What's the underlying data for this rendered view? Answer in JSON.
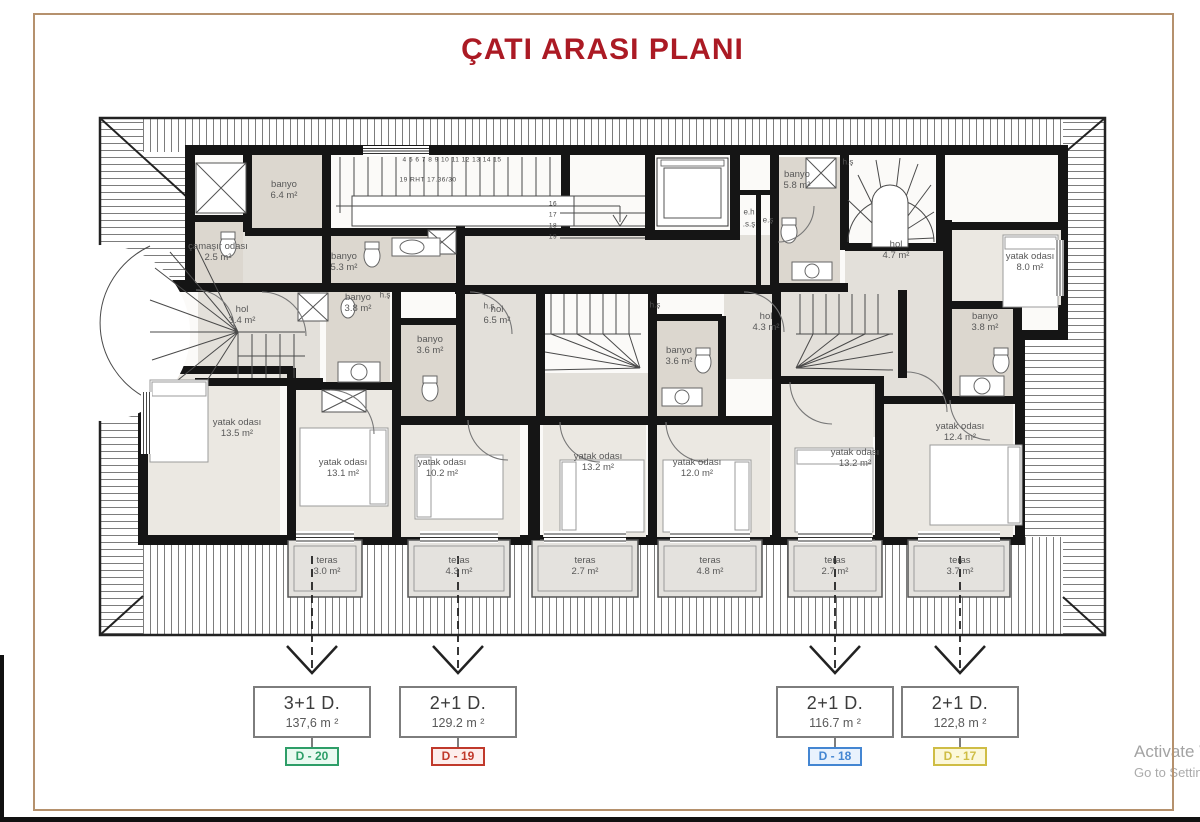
{
  "title": "ÇATI ARASI PLANI",
  "watermark": {
    "line1": "Activate W",
    "line2": "Go to Settin"
  },
  "plan": {
    "rooms": [
      {
        "name": "banyo",
        "area": "6.4 m²",
        "x": 284,
        "y": 190
      },
      {
        "name": "çamaşır odası",
        "area": "2.5 m²",
        "x": 218,
        "y": 252,
        "w": 60,
        "wrap": true
      },
      {
        "name": "banyo",
        "area": "5.3 m²",
        "x": 344,
        "y": 262
      },
      {
        "name": "hol",
        "area": "3.4 m²",
        "x": 242,
        "y": 315
      },
      {
        "name": "banyo",
        "area": "3.8 m²",
        "x": 358,
        "y": 303
      },
      {
        "name": "banyo",
        "area": "3.6 m²",
        "x": 430,
        "y": 345
      },
      {
        "name": "hol",
        "area": "6.5 m²",
        "x": 497,
        "y": 315
      },
      {
        "name": "yatak odası",
        "area": "13.5 m²",
        "x": 237,
        "y": 428
      },
      {
        "name": "yatak odası",
        "area": "13.1 m²",
        "x": 343,
        "y": 468
      },
      {
        "name": "yatak odası",
        "area": "10.2 m²",
        "x": 442,
        "y": 468
      },
      {
        "name": "yatak odası",
        "area": "13.2 m²",
        "x": 598,
        "y": 462
      },
      {
        "name": "yatak odası",
        "area": "12.0 m²",
        "x": 697,
        "y": 468
      },
      {
        "name": "banyo",
        "area": "3.6 m²",
        "x": 679,
        "y": 356
      },
      {
        "name": "hol",
        "area": "4.3 m²",
        "x": 766,
        "y": 322
      },
      {
        "name": "banyo",
        "area": "5.8 m²",
        "x": 797,
        "y": 180
      },
      {
        "name": "hol",
        "area": "4.7 m²",
        "x": 896,
        "y": 250
      },
      {
        "name": "yatak odası",
        "area": "8.0 m²",
        "x": 1030,
        "y": 262
      },
      {
        "name": "banyo",
        "area": "3.8 m²",
        "x": 985,
        "y": 322
      },
      {
        "name": "yatak odası",
        "area": "13.2 m²",
        "x": 855,
        "y": 458
      },
      {
        "name": "yatak odası",
        "area": "12.4 m²",
        "x": 960,
        "y": 432
      },
      {
        "name": "teras",
        "area": "3.0 m²",
        "x": 327,
        "y": 566
      },
      {
        "name": "teras",
        "area": "4.3 m²",
        "x": 459,
        "y": 566
      },
      {
        "name": "teras",
        "area": "2.7 m²",
        "x": 585,
        "y": 566
      },
      {
        "name": "teras",
        "area": "4.8 m²",
        "x": 710,
        "y": 566
      },
      {
        "name": "teras",
        "area": "2.7 m²",
        "x": 835,
        "y": 566
      },
      {
        "name": "teras",
        "area": "3.7 m²",
        "x": 960,
        "y": 566
      }
    ],
    "small_labels": [
      {
        "text": "h.ş",
        "x": 385,
        "y": 295
      },
      {
        "text": "h.ş",
        "x": 489,
        "y": 306
      },
      {
        "text": "h.ş",
        "x": 655,
        "y": 305
      },
      {
        "text": "h.ş",
        "x": 848,
        "y": 162
      },
      {
        "text": "e.h",
        "x": 749,
        "y": 212
      },
      {
        "text": ".s.ş",
        "x": 749,
        "y": 224
      },
      {
        "text": "e.ş",
        "x": 768,
        "y": 220
      }
    ],
    "stair_notes": [
      {
        "text": "19 RHT 17.36/30",
        "x": 428,
        "y": 180
      },
      {
        "text": "4    5    6    7    8    9    10    11    12    13    14    15",
        "x": 452,
        "y": 160
      },
      {
        "text": "16",
        "x": 553,
        "y": 204
      },
      {
        "text": "17",
        "x": 553,
        "y": 215
      },
      {
        "text": "18",
        "x": 553,
        "y": 226
      },
      {
        "text": "19",
        "x": 553,
        "y": 237
      }
    ]
  },
  "units": [
    {
      "type": "3+1 D.",
      "area": "137,6 m ²",
      "code": "D - 20",
      "x": 312,
      "accent": "#2e9e68",
      "bg": "#eafaf1"
    },
    {
      "type": "2+1 D.",
      "area": "129.2 m ²",
      "code": "D - 19",
      "x": 458,
      "accent": "#c0392b",
      "bg": "#fdeeec"
    },
    {
      "type": "2+1 D.",
      "area": "116.7 m ²",
      "code": "D - 18",
      "x": 835,
      "accent": "#4486d2",
      "bg": "#e9f2fd"
    },
    {
      "type": "2+1 D.",
      "area": "122,8 m ²",
      "code": "D - 17",
      "x": 960,
      "accent": "#cfbd45",
      "bg": "#fcf8da"
    }
  ]
}
